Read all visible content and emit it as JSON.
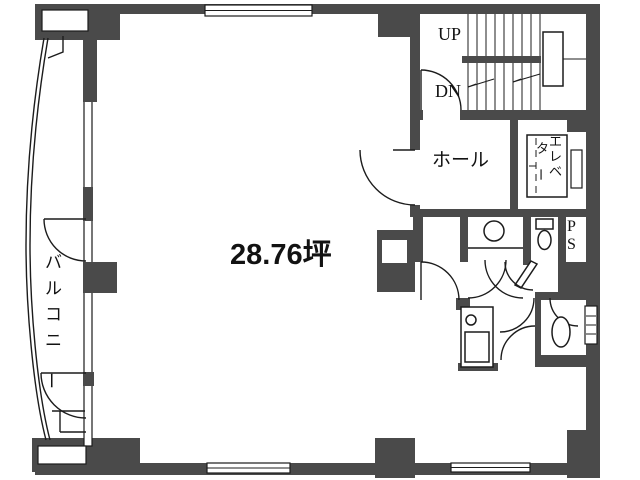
{
  "floor_plan": {
    "area_label": "28.76坪",
    "balcony_label": "バルコニー",
    "hall_label": "ホール",
    "elevator_label_col1": "エレベ",
    "elevator_label_col2": "ター",
    "stairs_up_label": "UP",
    "stairs_down_label": "DN",
    "pipe_space_label": "PS",
    "colors": {
      "wall": "#4a4a4a",
      "line": "#1c1c1c",
      "background": "#ffffff"
    }
  }
}
